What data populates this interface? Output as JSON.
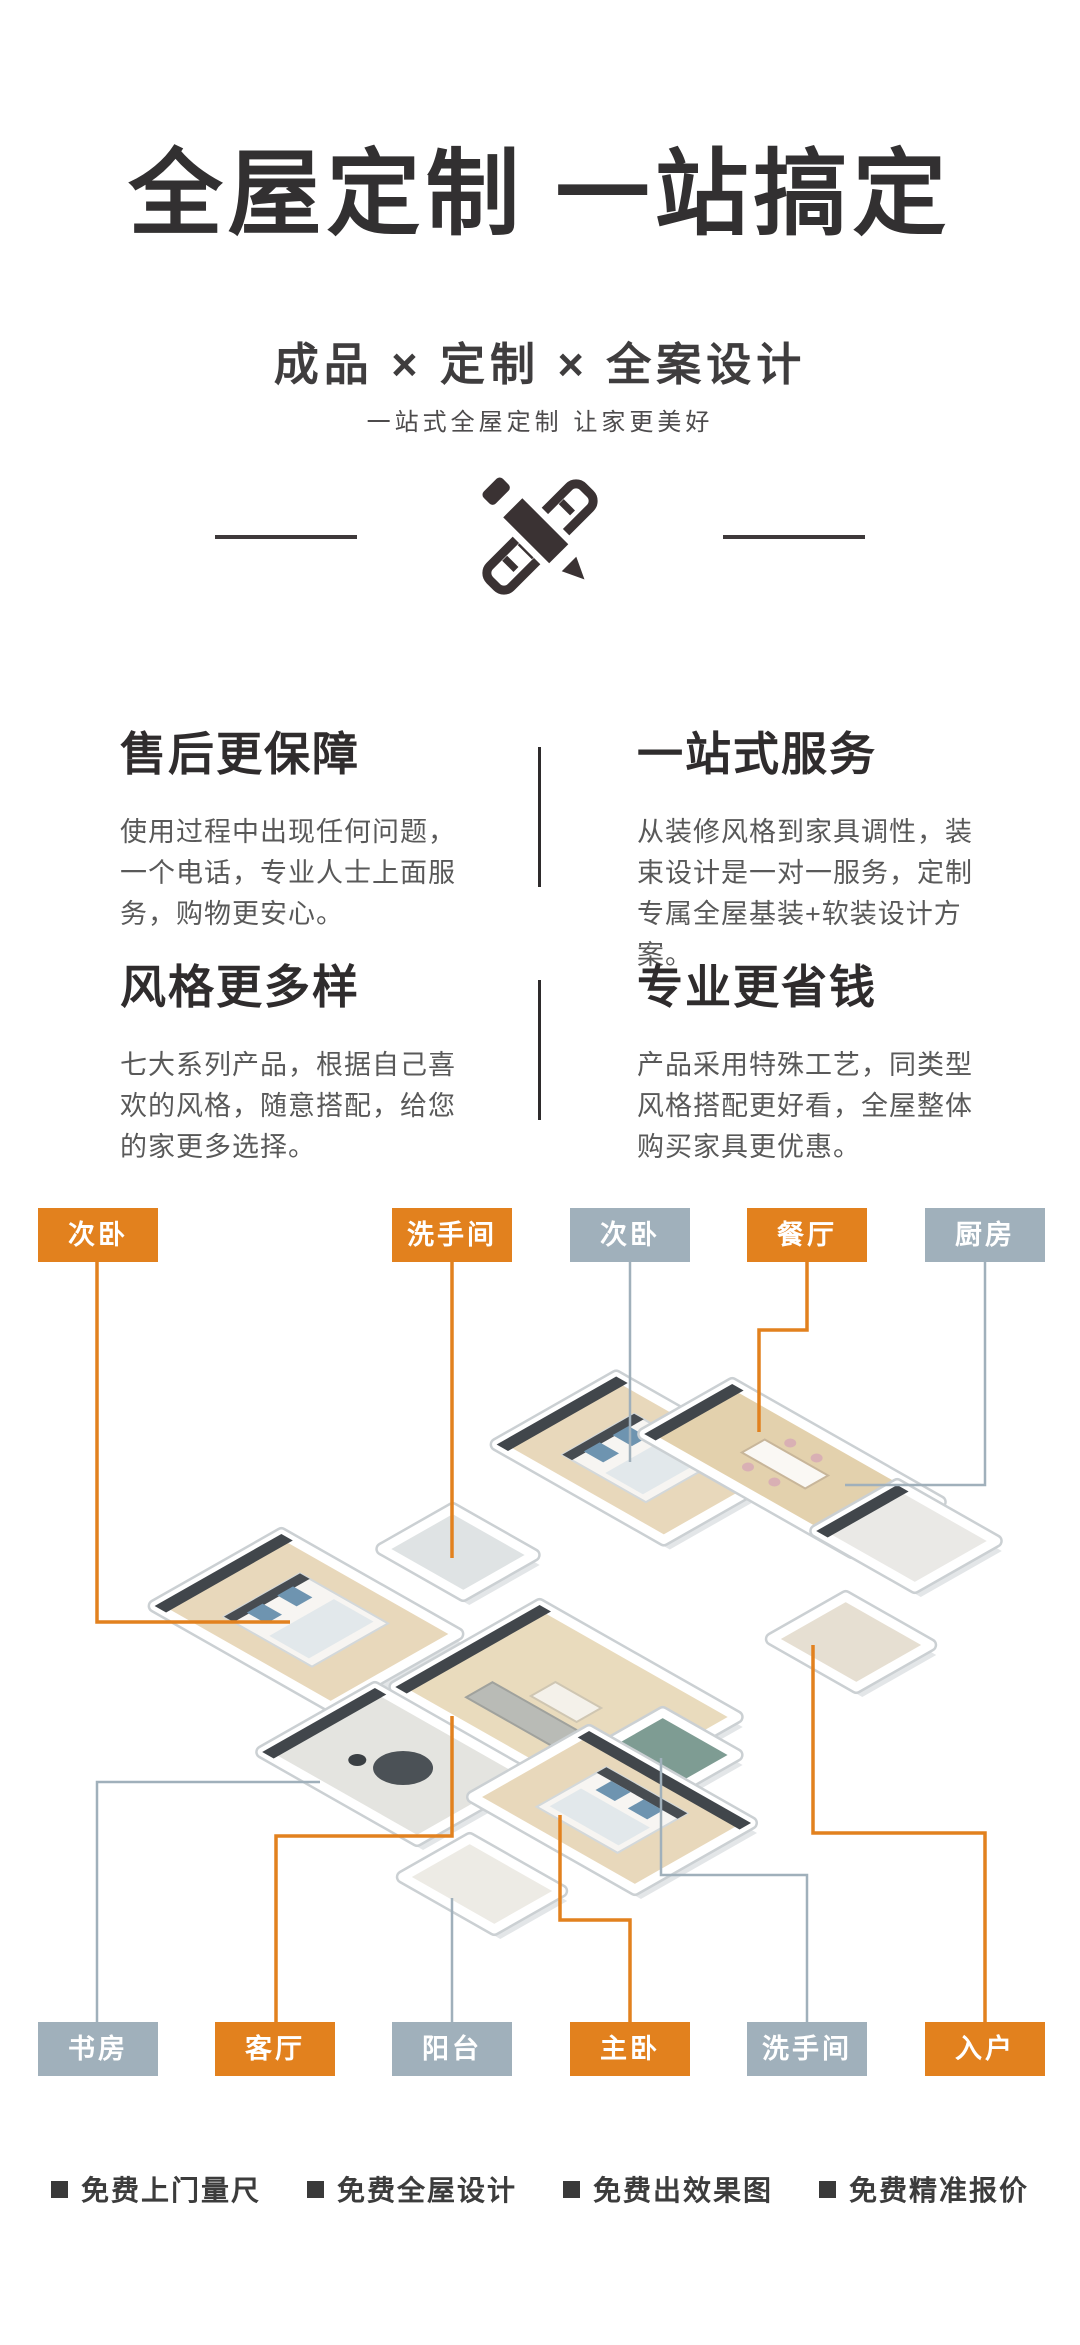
{
  "hero": {
    "title": "全屋定制 一站搞定",
    "subtitle": "成品 × 定制 × 全案设计",
    "tagline": "一站式全屋定制 让家更美好"
  },
  "features": [
    {
      "title": "售后更保障",
      "body": "使用过程中出现任何问题，一个电话，专业人士上面服务，购物更安心。"
    },
    {
      "title": "一站式服务",
      "body": "从装修风格到家具调性，装束设计是一对一服务，定制专属全屋基装+软装设计方案。"
    },
    {
      "title": "风格更多样",
      "body": "七大系列产品，根据自己喜欢的风格，随意搭配，给您的家更多选择。"
    },
    {
      "title": "专业更省钱",
      "body": "产品采用特殊工艺，同类型风格搭配更好看，全屋整体购买家具更优惠。"
    }
  ],
  "floorplan": {
    "colors": {
      "orange": "#E2811E",
      "gray": "#A0B0BB",
      "wall": "#ffffff",
      "wall_edge": "#cbd0d3",
      "shadow": "#e3e6e8",
      "dark_accent": "#41464b"
    },
    "top_labels": [
      {
        "label": "次卧",
        "color": "orange",
        "x": 38,
        "y": 1208
      },
      {
        "label": "洗手间",
        "color": "orange",
        "x": 392,
        "y": 1208
      },
      {
        "label": "次卧",
        "color": "gray",
        "x": 570,
        "y": 1208
      },
      {
        "label": "餐厅",
        "color": "orange",
        "x": 747,
        "y": 1208
      },
      {
        "label": "厨房",
        "color": "gray",
        "x": 925,
        "y": 1208
      }
    ],
    "bottom_labels": [
      {
        "label": "书房",
        "color": "gray",
        "x": 38,
        "y": 2022
      },
      {
        "label": "客厅",
        "color": "orange",
        "x": 215,
        "y": 2022
      },
      {
        "label": "阳台",
        "color": "gray",
        "x": 392,
        "y": 2022
      },
      {
        "label": "主卧",
        "color": "orange",
        "x": 570,
        "y": 2022
      },
      {
        "label": "洗手间",
        "color": "gray",
        "x": 747,
        "y": 2022
      },
      {
        "label": "入户",
        "color": "orange",
        "x": 925,
        "y": 2022
      }
    ],
    "connectors": [
      {
        "name": "line-bedroom2-top",
        "color": "orange",
        "width": 3.5,
        "points": [
          [
            97,
            72
          ],
          [
            97,
            432
          ],
          [
            290,
            432
          ]
        ]
      },
      {
        "name": "line-bath1-top",
        "color": "orange",
        "width": 3.5,
        "points": [
          [
            452,
            72
          ],
          [
            452,
            368
          ]
        ]
      },
      {
        "name": "line-bedroom3-top",
        "color": "gray",
        "width": 2.5,
        "points": [
          [
            630,
            72
          ],
          [
            630,
            272
          ]
        ]
      },
      {
        "name": "line-dining-top",
        "color": "orange",
        "width": 3.5,
        "points": [
          [
            807,
            72
          ],
          [
            807,
            140
          ],
          [
            759,
            140
          ],
          [
            759,
            242
          ]
        ]
      },
      {
        "name": "line-kitchen-top",
        "color": "gray",
        "width": 2.5,
        "points": [
          [
            985,
            72
          ],
          [
            985,
            295
          ],
          [
            845,
            295
          ]
        ]
      },
      {
        "name": "line-study-bottom",
        "color": "gray",
        "width": 2.5,
        "points": [
          [
            97,
            832
          ],
          [
            97,
            592
          ],
          [
            320,
            592
          ]
        ]
      },
      {
        "name": "line-living-bottom",
        "color": "orange",
        "width": 3.5,
        "points": [
          [
            276,
            832
          ],
          [
            276,
            646
          ],
          [
            452,
            646
          ],
          [
            452,
            526
          ]
        ]
      },
      {
        "name": "line-balcony-bottom",
        "color": "gray",
        "width": 2.5,
        "points": [
          [
            452,
            832
          ],
          [
            452,
            708
          ]
        ]
      },
      {
        "name": "line-master-bottom",
        "color": "orange",
        "width": 3.5,
        "points": [
          [
            630,
            832
          ],
          [
            630,
            730
          ],
          [
            560,
            730
          ],
          [
            560,
            625
          ]
        ]
      },
      {
        "name": "line-bath2-bottom",
        "color": "gray",
        "width": 2.5,
        "points": [
          [
            807,
            832
          ],
          [
            807,
            685
          ],
          [
            661,
            685
          ],
          [
            661,
            568
          ]
        ]
      },
      {
        "name": "line-entry-bottom",
        "color": "orange",
        "width": 3.5,
        "points": [
          [
            985,
            832
          ],
          [
            985,
            643
          ],
          [
            813,
            643
          ],
          [
            813,
            455
          ]
        ]
      }
    ],
    "rooms": [
      {
        "name": "bedroom-top",
        "cx": 640,
        "cy": 268,
        "w": 95,
        "h": 68,
        "floor": "#e8d8bb",
        "accents": [
          "strip-nw",
          "bed-nw"
        ]
      },
      {
        "name": "dining",
        "cx": 792,
        "cy": 278,
        "w": 118,
        "h": 50,
        "floor": "#e3d1ad",
        "accents": [
          "strip-nw",
          "table"
        ]
      },
      {
        "name": "kitchen",
        "cx": 906,
        "cy": 346,
        "w": 56,
        "h": 46,
        "floor": "#eae9e6",
        "accents": [
          "strip-nw"
        ]
      },
      {
        "name": "bathroom-1",
        "cx": 458,
        "cy": 362,
        "w": 46,
        "h": 40,
        "floor": "#dfe3e4",
        "accents": []
      },
      {
        "name": "bedroom-left",
        "cx": 306,
        "cy": 430,
        "w": 100,
        "h": 72,
        "floor": "#e8d8bb",
        "accents": [
          "strip-nw",
          "bed-nw"
        ]
      },
      {
        "name": "entry",
        "cx": 851,
        "cy": 452,
        "w": 48,
        "h": 42,
        "floor": "#e6dfd2",
        "accents": []
      },
      {
        "name": "living",
        "cx": 566,
        "cy": 512,
        "w": 112,
        "h": 82,
        "floor": "#e9dbbd",
        "accents": [
          "strip-nw",
          "sofa"
        ]
      },
      {
        "name": "bathroom-2",
        "cx": 668,
        "cy": 562,
        "w": 42,
        "h": 36,
        "floor": "#7e9c93",
        "accents": []
      },
      {
        "name": "study",
        "cx": 396,
        "cy": 574,
        "w": 88,
        "h": 64,
        "floor": "#e4e4e0",
        "accents": [
          "strip-nw",
          "rug"
        ]
      },
      {
        "name": "master-bedroom",
        "cx": 612,
        "cy": 620,
        "w": 92,
        "h": 66,
        "floor": "#e8d8bb",
        "accents": [
          "strip-ne",
          "bed-ne"
        ]
      },
      {
        "name": "balcony",
        "cx": 482,
        "cy": 694,
        "w": 52,
        "h": 38,
        "floor": "#edebe5",
        "accents": []
      }
    ]
  },
  "footer": {
    "items": [
      "免费上门量尺",
      "免费全屋设计",
      "免费出效果图",
      "免费精准报价"
    ]
  }
}
